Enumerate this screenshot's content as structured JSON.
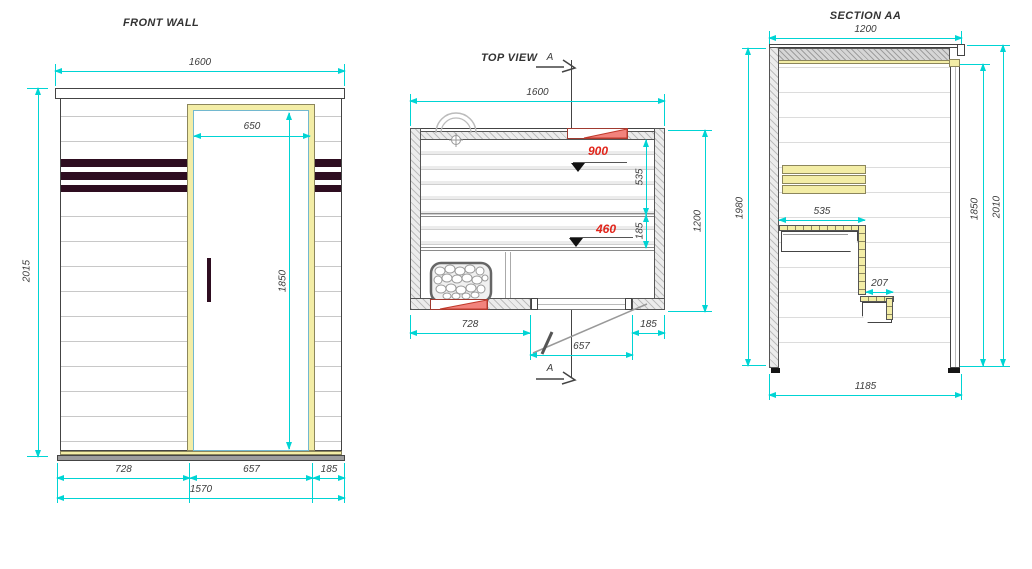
{
  "colors": {
    "dim": "#00d4d4",
    "red": "#e1251b",
    "wood": "#f3eda6",
    "dark": "#2e0d20"
  },
  "views": {
    "front_wall": {
      "title": "FRONT WALL",
      "width": "1600",
      "door_width": "650",
      "height": "2015",
      "door_height": "1850",
      "seg_left": "728",
      "seg_door": "657",
      "seg_right": "185",
      "total_width": "1570"
    },
    "top_view": {
      "title": "TOP VIEW",
      "section_letter": "A",
      "width": "1600",
      "depth": "1200",
      "bench_depth": "535",
      "bench_front": "185",
      "seg_left": "728",
      "door_opening": "657",
      "seg_right": "185",
      "level_upper": "900",
      "level_lower": "460"
    },
    "section_aa": {
      "title": "SECTION AA",
      "width": "1200",
      "height_left": "1980",
      "bench_width": "535",
      "step_width": "207",
      "inner_height": "1850",
      "outer_height": "2010",
      "floor_width": "1185"
    }
  }
}
